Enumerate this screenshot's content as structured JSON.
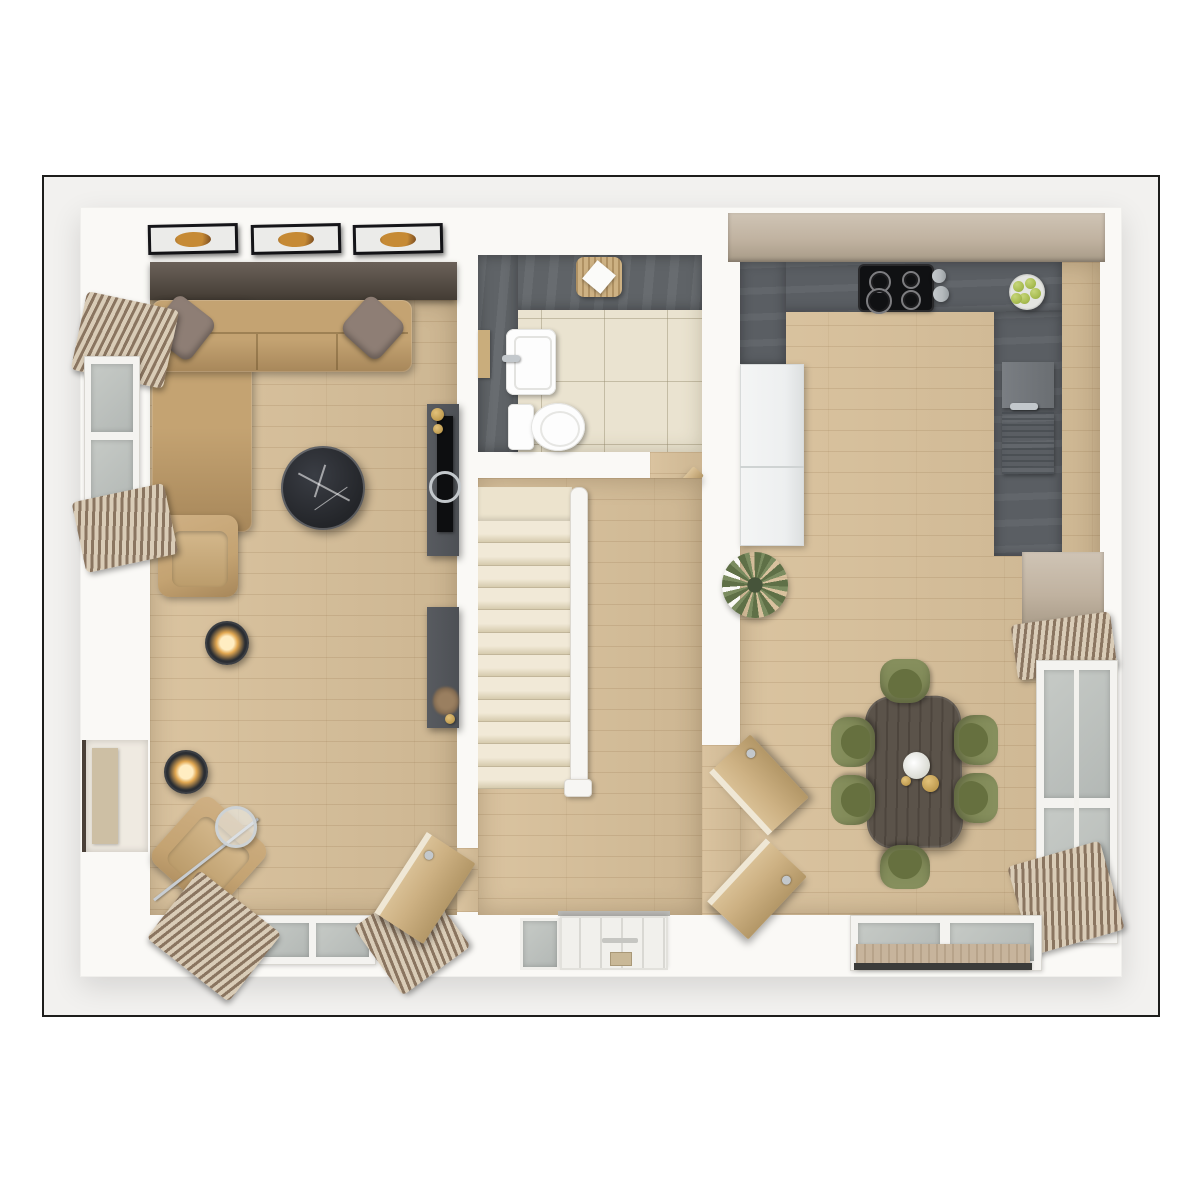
{
  "palette": {
    "frame_border": "#1d1d1b",
    "canvas": "#f2f1ef",
    "wall": "#faf9f6",
    "wood": "#d8c09a",
    "wood_line": "rgba(130,95,55,0.16)",
    "accent_top": "#6b6159",
    "accent_bottom": "#433c34",
    "art_frame": "#16161a",
    "art_mat": "#ebebe9",
    "art_orange": "#c68a35",
    "art_brown": "#6f431d",
    "sofa": "#c4a372",
    "sofa_dark": "#a7875a",
    "sofa_seam": "rgba(90,65,30,0.35)",
    "pillow": "#8e7e75",
    "marble": "#232529",
    "marble_hi": "#3a3d44",
    "unit_gray": "#4d5055",
    "tv_black": "#0d0e10",
    "chrome": "#c3c8cc",
    "lamp_body": "#2b2e33",
    "lamp_glow_in": "#ffedc2",
    "lamp_glow_out": "#e2a852",
    "stair": "#ece3cd",
    "stair_shadow": "#d6cbae",
    "rail": "#f7f6f3",
    "tile": "#eae3d0",
    "grout": "rgba(150,140,110,0.45)",
    "slate": "#5f6367",
    "white_fix": "#fdfdfd",
    "counter": "#5a5e63",
    "hob": "#101113",
    "greige": "#c0b2a0",
    "greige_dark": "#a79a87",
    "fridge": "#edeff0",
    "steel": "#b4b9bc",
    "olive": "#7a8352",
    "olive_dark": "#66703f",
    "table_wood": "#5b534a",
    "table_line": "rgba(35,28,22,0.25)",
    "door_wood": "#cdb183",
    "door_wood_dark": "#b39767",
    "curtain_a": "#8a7560",
    "curtain_b": "#d9ccb7",
    "glass": "#c6cac6",
    "glass_dark": "#b3b8b5",
    "mat_beige": "#c7b49c",
    "apple": "#a9bd52",
    "gold": "#b08b3e",
    "plant_a": "#5f7047",
    "plant_b": "#7b8c60"
  },
  "scene": {
    "rooms": [
      {
        "name": "living-room"
      },
      {
        "name": "wc-bathroom"
      },
      {
        "name": "hallway-stairs"
      },
      {
        "name": "kitchen-dining"
      }
    ],
    "wall_art": {
      "count": 3,
      "x_positions": [
        148,
        251,
        353
      ]
    },
    "stairs": {
      "step_count": 12
    },
    "hob_burners": [
      {
        "x": 878,
        "y": 280,
        "r": 9
      },
      {
        "x": 909,
        "y": 278,
        "r": 7
      },
      {
        "x": 877,
        "y": 299,
        "r": 11
      },
      {
        "x": 909,
        "y": 298,
        "r": 8
      }
    ],
    "dining_chairs": [
      {
        "x": 905,
        "y": 681,
        "rot": 0
      },
      {
        "x": 853,
        "y": 742,
        "rot": -90
      },
      {
        "x": 853,
        "y": 800,
        "rot": -90
      },
      {
        "x": 976,
        "y": 740,
        "rot": 90
      },
      {
        "x": 976,
        "y": 798,
        "rot": 90
      },
      {
        "x": 905,
        "y": 867,
        "rot": 180
      }
    ],
    "apples": [
      {
        "dx": -9,
        "dy": -6
      },
      {
        "dx": 3,
        "dy": -9
      },
      {
        "dx": 8,
        "dy": 1
      },
      {
        "dx": -3,
        "dy": 6
      },
      {
        "dx": -11,
        "dy": 6
      }
    ]
  }
}
